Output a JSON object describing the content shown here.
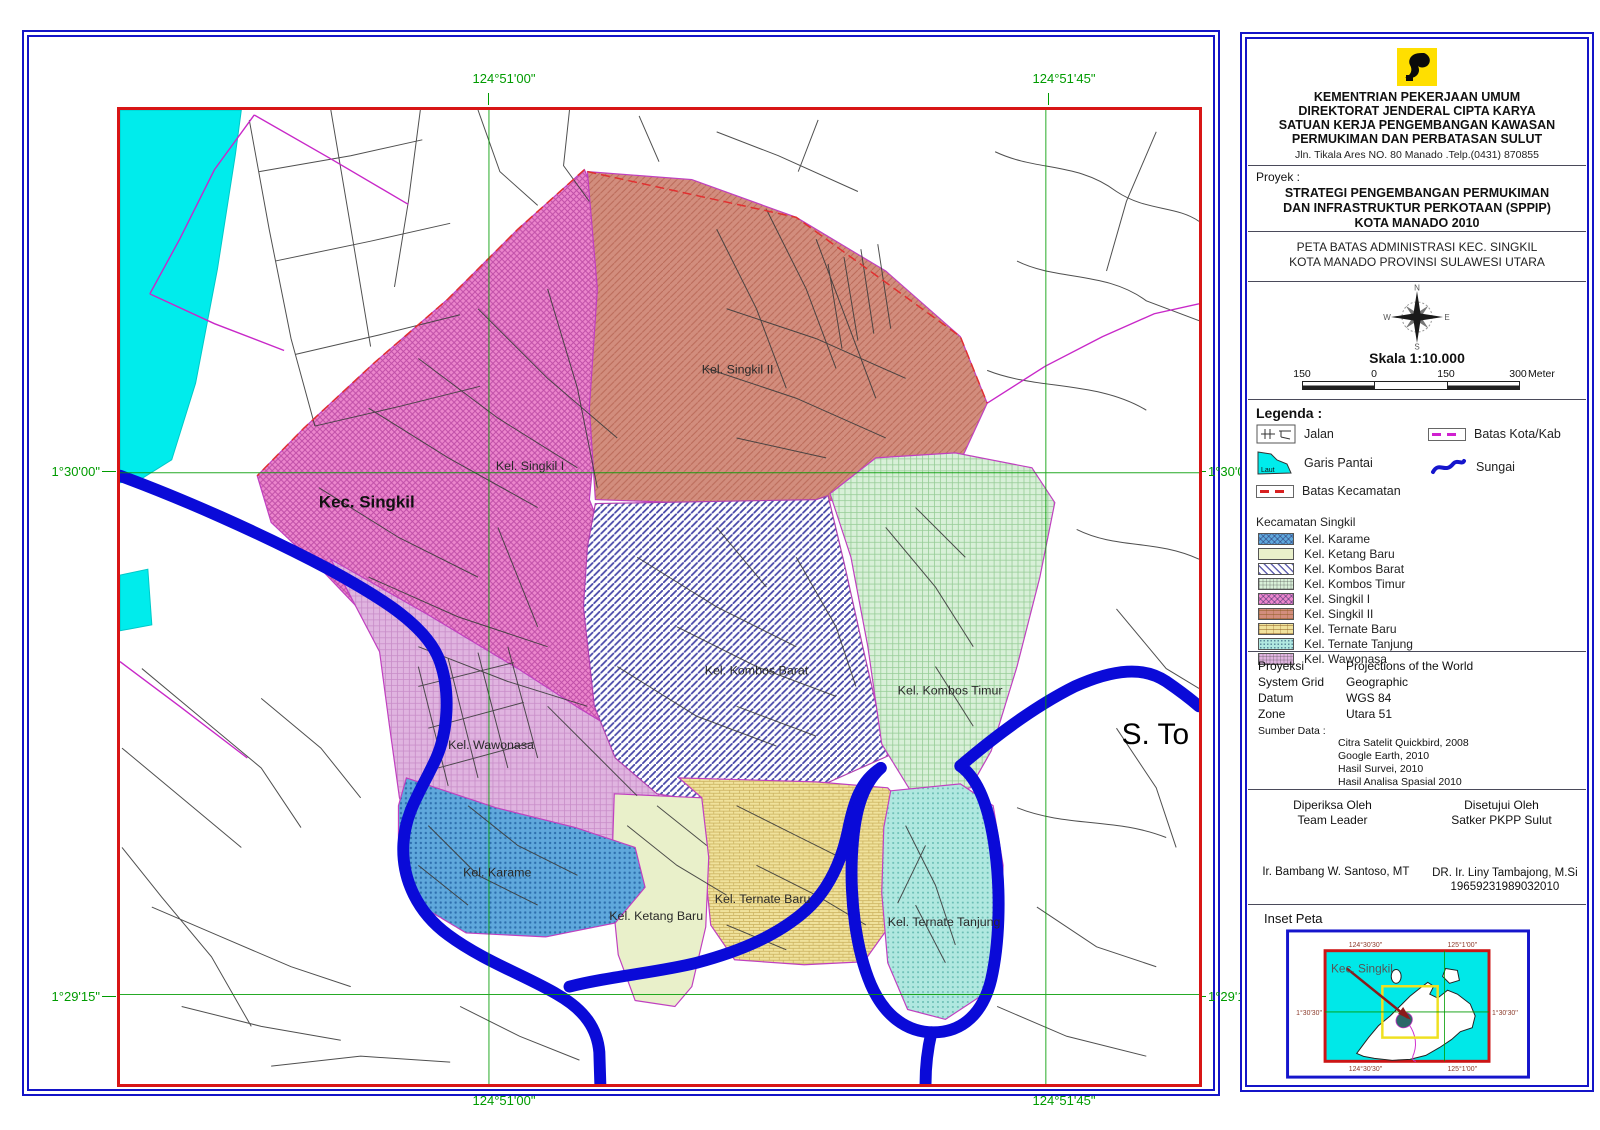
{
  "panel": {
    "header": {
      "org_lines": [
        "KEMENTRIAN PEKERJAAN UMUM",
        "DIREKTORAT JENDERAL CIPTA KARYA",
        "SATUAN KERJA PENGEMBANGAN KAWASAN",
        "PERMUKIMAN DAN PERBATASAN SULUT"
      ],
      "address": "Jln. Tikala Ares NO. 80  Manado .Telp.(0431) 870855"
    },
    "proyek": {
      "label": "Proyek :",
      "lines": [
        "STRATEGI PENGEMBANGAN PERMUKIMAN",
        "DAN INFRASTRUKTUR PERKOTAAN (SPPIP)",
        "KOTA MANADO 2010"
      ]
    },
    "map_title": {
      "line1": "PETA BATAS ADMINISTRASI KEC. SINGKIL",
      "line2": "KOTA MANADO PROVINSI SULAWESI UTARA"
    },
    "compass": {
      "n": "N",
      "e": "E",
      "s": "S",
      "w": "W"
    },
    "scale": {
      "label": "Skala  1:10.000",
      "ticks": [
        "150",
        "0",
        "150",
        "300"
      ],
      "unit": "Meter"
    },
    "legend": {
      "title": "Legenda :",
      "jalan": "Jalan",
      "batas_kota": "Batas Kota/Kab",
      "garis_pantai": "Garis Pantai",
      "laut": "Laut",
      "sungai": "Sungai",
      "batas_kecamatan": "Batas Kecamatan",
      "district_title": "Kecamatan Singkil",
      "kelurahan": [
        {
          "label": "Kel. Karame",
          "color": "#5FA8DC",
          "pattern": "cross"
        },
        {
          "label": "Kel. Ketang Baru",
          "color": "#E9F0CA",
          "pattern": "plain"
        },
        {
          "label": "Kel. Kombos Barat",
          "color": "#FFFFFF",
          "pattern": "diag"
        },
        {
          "label": "Kel. Kombos Timur",
          "color": "#D8F0D8",
          "pattern": "grid"
        },
        {
          "label": "Kel. Singkil I",
          "color": "#EC86CC",
          "pattern": "cross"
        },
        {
          "label": "Kel. Singkil II",
          "color": "#D28D7D",
          "pattern": "brick"
        },
        {
          "label": "Kel. Ternate Baru",
          "color": "#F0E29C",
          "pattern": "brick"
        },
        {
          "label": "Kel. Ternate Tanjung",
          "color": "#B0E8E0",
          "pattern": "dots"
        },
        {
          "label": "Kel. Wawonasa",
          "color": "#E0B4E0",
          "pattern": "grid"
        }
      ]
    },
    "projection": {
      "rows": [
        {
          "key": "Proyeksi",
          "value": "Projections of the World"
        },
        {
          "key": "System Grid",
          "value": "Geographic"
        },
        {
          "key": "Datum",
          "value": "WGS 84"
        },
        {
          "key": "Zone",
          "value": "Utara 51"
        }
      ],
      "sumber_label": "Sumber Data :",
      "sumber": [
        "Citra Satelit Quickbird, 2008",
        "Google Earth, 2010",
        "Hasil Survei, 2010",
        "Hasil Analisa Spasial 2010"
      ]
    },
    "approval": {
      "left_role_1": "Diperiksa Oleh",
      "left_role_2": "Team Leader",
      "right_role_1": "Disetujui Oleh",
      "right_role_2": "Satker PKPP Sulut",
      "left_name": "Ir. Bambang W. Santoso, MT",
      "right_name": "DR. Ir. Liny Tambajong, M.Si",
      "right_nip": "19659231989032010"
    },
    "inset": {
      "title": "Inset Peta",
      "label": "Kec. Singkil",
      "coord_top_left": "124°30'30''",
      "coord_top_right": "125°1'00''",
      "coord_bottom_left": "124°30'30''",
      "coord_bottom_right": "125°1'00''",
      "coord_left": "1°30'30''",
      "coord_right": "1°30'30''"
    }
  },
  "map": {
    "coord_top_left": "124°51'00\"",
    "coord_top_right": "124°51'45\"",
    "coord_bottom_left": "124°51'00\"",
    "coord_bottom_right": "124°51'45\"",
    "coord_left_top": "1°30'00\"",
    "coord_left_bottom": "1°29'15\"",
    "coord_right_top": "1°30'00\"",
    "coord_right_bottom": "1°29'15\"",
    "labels": [
      "Kec. Singkil",
      "Kel. Singkil I",
      "Kel. Singkil II",
      "Kel. Kombos Barat",
      "Kel. Kombos Timur",
      "Kel. Wawonasa",
      "Kel. Karame",
      "Kel. Ketang Baru",
      "Kel. Ternate Baru",
      "Kel. Ternate Tanjung",
      "S. To"
    ],
    "colors": {
      "sea": "#00ECEC",
      "river": "#0A0AD8",
      "grid": "#009B00",
      "frame": "#D81616",
      "border": "#1414C8"
    }
  }
}
